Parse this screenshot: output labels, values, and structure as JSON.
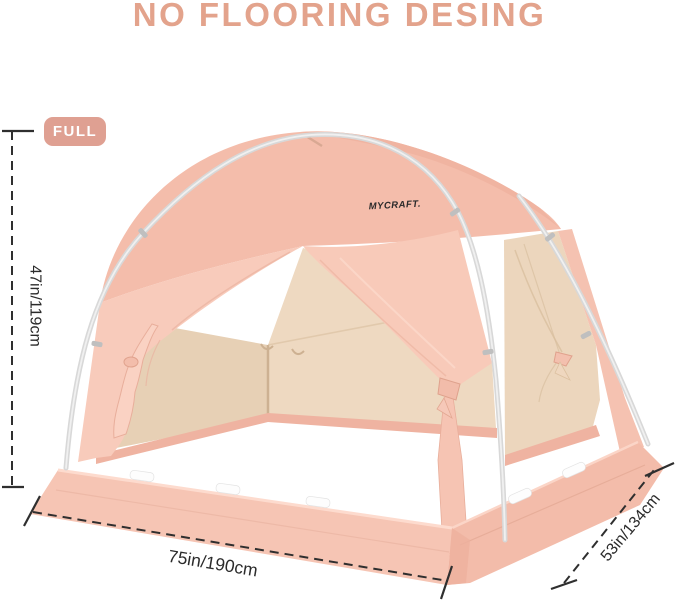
{
  "title": "NO FLOORING DESING",
  "badge": {
    "label": "FULL"
  },
  "brand": {
    "logo": "MYCRAFT."
  },
  "dimensions": {
    "height": {
      "label": "47in/119cm",
      "position": "left-vertical"
    },
    "width": {
      "label": "75in/190cm",
      "position": "bottom"
    },
    "depth": {
      "label": "53in/134cm",
      "position": "right-diagonal"
    }
  },
  "colors": {
    "accent_text": "#e3a38c",
    "badge_bg": "#dfa092",
    "tent_front": "#f8cbbb",
    "tent_dome": "#f4bdab",
    "tent_interior": "#eed9c1",
    "tent_skirt": "#f6c5b4",
    "pole": "#d8d8d8",
    "dimension_line": "#2f2f2f"
  }
}
